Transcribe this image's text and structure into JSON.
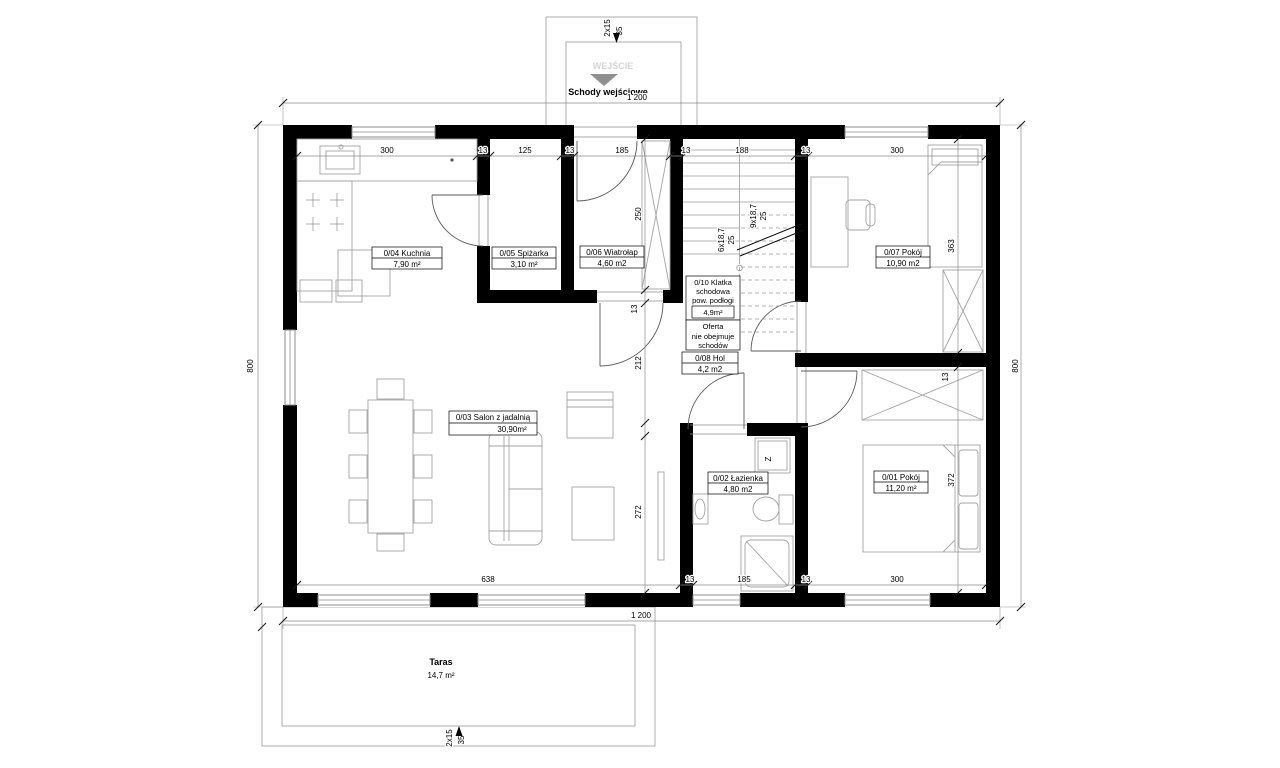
{
  "entrance": {
    "sign": "WEJŚCIE",
    "label": "Schody wejściowe",
    "steps_count": "2x15",
    "steps_run": "35"
  },
  "terrace": {
    "name": "Taras",
    "area": "14,7 m²",
    "steps_count": "2x15",
    "steps_run": "35"
  },
  "rooms": {
    "bedroom1": {
      "name": "0/01 Pokój",
      "area": "11,20 m²"
    },
    "bathroom": {
      "name": "0/02 Łazienka",
      "area": "4,80 m2"
    },
    "livingroom": {
      "name": "0/03 Salon z jadalnią",
      "area": "30,90m²"
    },
    "kitchen": {
      "name": "0/04 Kuchnia",
      "area": "7,90 m²"
    },
    "pantry": {
      "name": "0/05 Spiżarka",
      "area": "3,10 m²"
    },
    "vestibule": {
      "name": "0/06 Wiatrołap",
      "area": "4,60 m2"
    },
    "hall": {
      "name": "0/08 Hol",
      "area": "4,2 m2"
    },
    "bedroom2": {
      "name": "0/07 Pokój",
      "area": "10,90 m2"
    },
    "staircase": {
      "name_l1": "0/10 Klatka",
      "name_l2": "schodowa",
      "name_l3": "pow. podłogi",
      "area": "4,9m²",
      "note_l1": "Oferta",
      "note_l2": "nie obejmuje",
      "note_l3": "schodów"
    }
  },
  "stairs": {
    "lower_flight": "6x18,7",
    "lower_run": "25",
    "upper_flight": "9x18,7",
    "upper_run": "25"
  },
  "appliances": {
    "washer_symbol": "Z"
  },
  "dimensions": {
    "total_width_top": "1 200",
    "total_width_bottom": "1 200",
    "height_left": "800",
    "height_right": "800",
    "top_row": [
      "300",
      "13",
      "125",
      "13",
      "185",
      "13",
      "188",
      "13",
      "300"
    ],
    "bottom_row": [
      "638",
      "13",
      "185",
      "13",
      "300"
    ],
    "left_chain": [
      "250",
      "13",
      "212",
      "272"
    ],
    "bed2_depth": "363",
    "wall_thickness": "13",
    "bed1_depth": "372"
  }
}
